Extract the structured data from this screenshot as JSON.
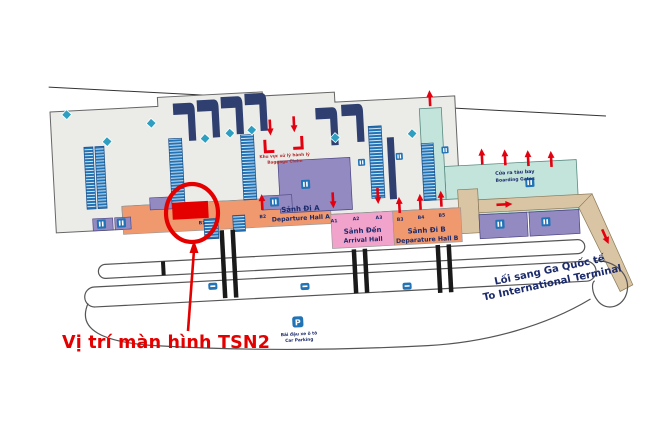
{
  "annotation": {
    "label": "Vị trí màn hình TSN2"
  },
  "areas": {
    "departure_hall_a": {
      "vi": "Sảnh Đi A",
      "en": "Departure Hall A"
    },
    "arrival_hall": {
      "vi": "Sảnh Đến",
      "en": "Arrival Hall"
    },
    "departure_hall_b": {
      "vi": "Sảnh Đi B",
      "en": "Deparature Hall B"
    },
    "boarding_gates": {
      "vi": "Cửa ra tàu bay",
      "en": "Boarding Gates"
    },
    "baggage_claim": {
      "vi": "Khu vực xử lý hành lý",
      "en": "Baggage Claim"
    },
    "international_walkway": {
      "vi": "Lối sang Ga Quốc tế",
      "en": "To International Terminal"
    },
    "car_parking": {
      "vi": "Bãi đậu xe ô tô",
      "en": "Car Parking",
      "icon": "P"
    }
  },
  "doors": {
    "hall_a": [
      "B1",
      "B2"
    ],
    "arrival": [
      "A1",
      "A2",
      "A3"
    ],
    "hall_b": [
      "B3",
      "B4",
      "B5"
    ]
  },
  "colors": {
    "highlight_red": "#e50000",
    "hall_orange": "#f0996e",
    "arrival_pink": "#f2a3cb",
    "boarding_teal": "#c3e4db",
    "room_purple": "#938ac2",
    "counter_blue": "#2273b5",
    "carousel_navy": "#2e3f70",
    "walkway_tan": "#d9c4a3",
    "label_navy": "#1b2a6b"
  }
}
